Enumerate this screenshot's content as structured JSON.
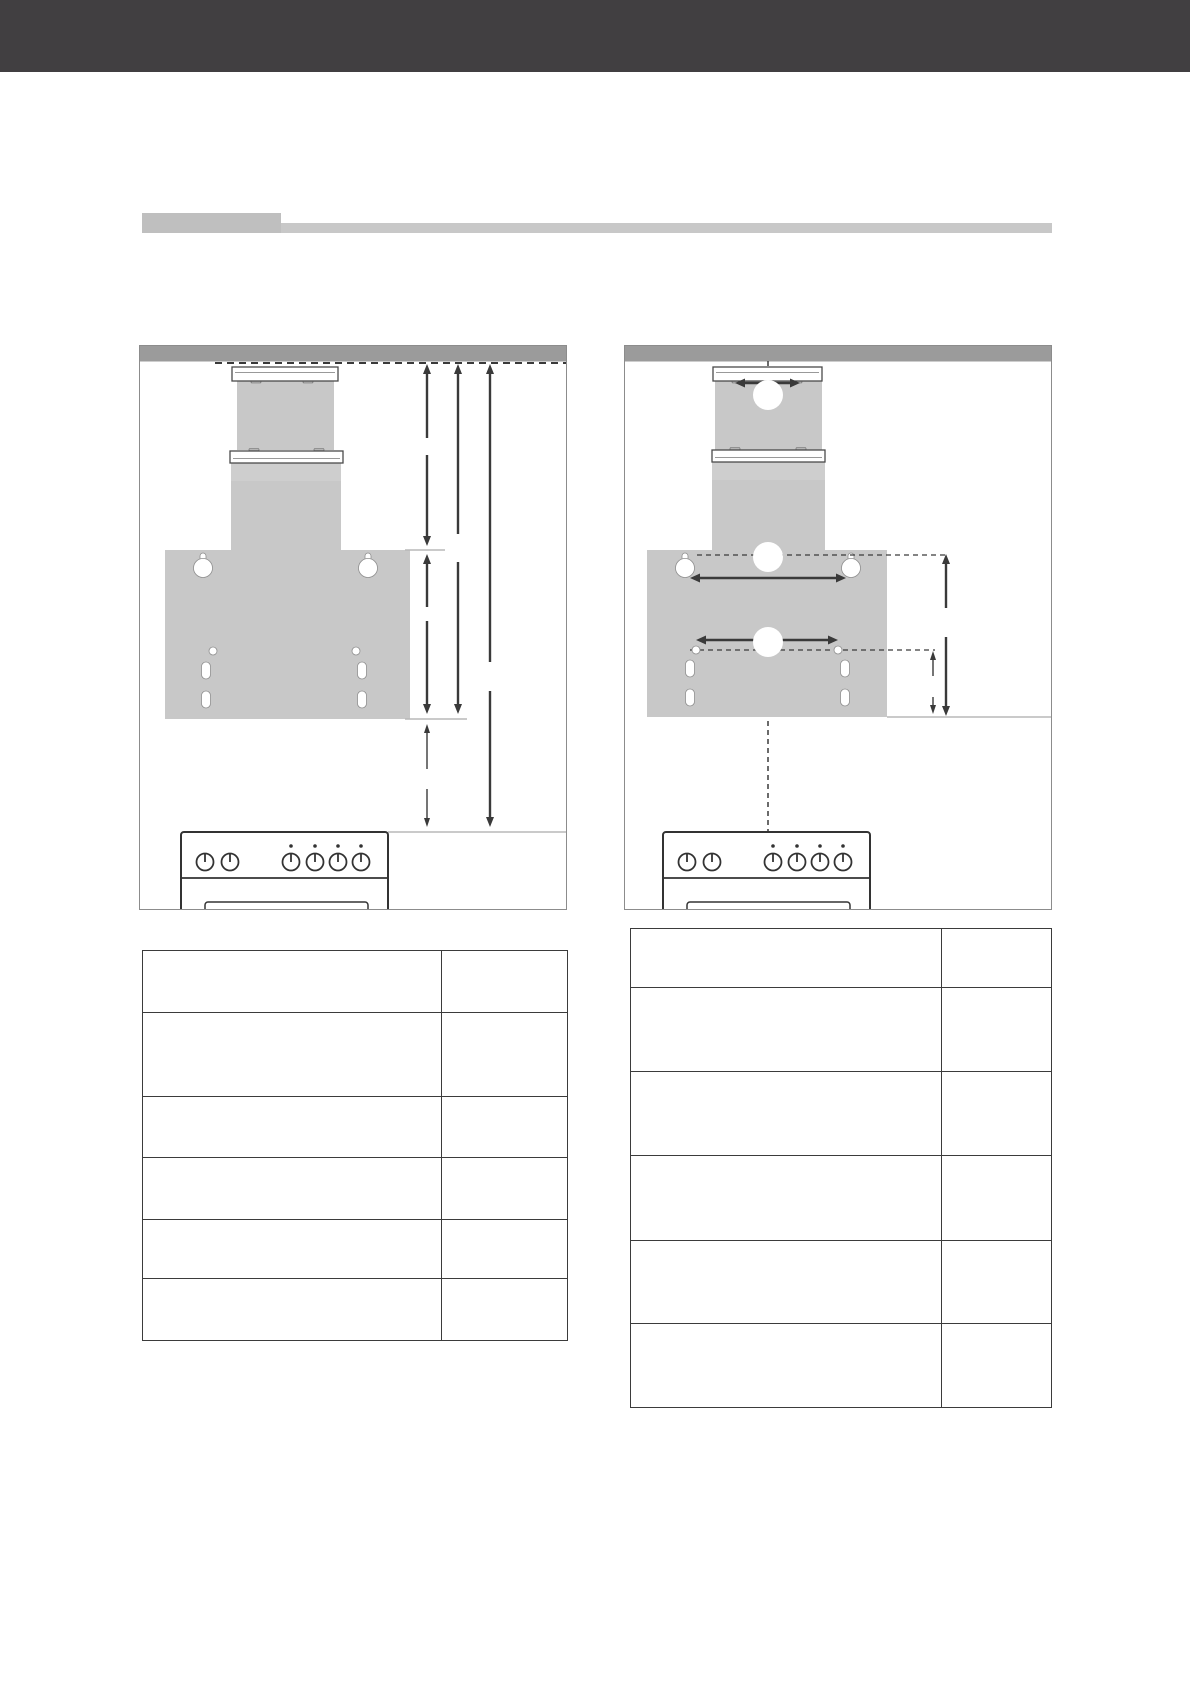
{
  "page": {
    "background": "#ffffff",
    "top_banner_color": "#413f41",
    "heading_block_color": "#bfbfbf",
    "heading_bar_color": "#c8c8c8",
    "heading_text": ""
  },
  "colors": {
    "diagram_border": "#8c8c8c",
    "ceiling_band": "#9b9b9b",
    "appliance_gray": "#c8c8c8",
    "dimension_line": "#3a3a3a",
    "reference_line_light": "#b8b8b8",
    "stove_outline": "#333333",
    "table_border": "#3b3b3b"
  },
  "diagram_left": {
    "dimension_labels": [
      "",
      "",
      "",
      "",
      ""
    ]
  },
  "diagram_right": {
    "callouts": [
      "",
      "",
      ""
    ],
    "dimension_labels": [
      "",
      "",
      "",
      ""
    ]
  },
  "tables": {
    "left": {
      "rows": [
        [
          "",
          ""
        ],
        [
          "",
          ""
        ],
        [
          "",
          ""
        ],
        [
          "",
          ""
        ],
        [
          "",
          ""
        ],
        [
          "",
          ""
        ]
      ]
    },
    "right": {
      "rows": [
        [
          "",
          ""
        ],
        [
          "",
          ""
        ],
        [
          "",
          ""
        ],
        [
          "",
          ""
        ],
        [
          "",
          ""
        ],
        [
          "",
          ""
        ]
      ]
    }
  }
}
